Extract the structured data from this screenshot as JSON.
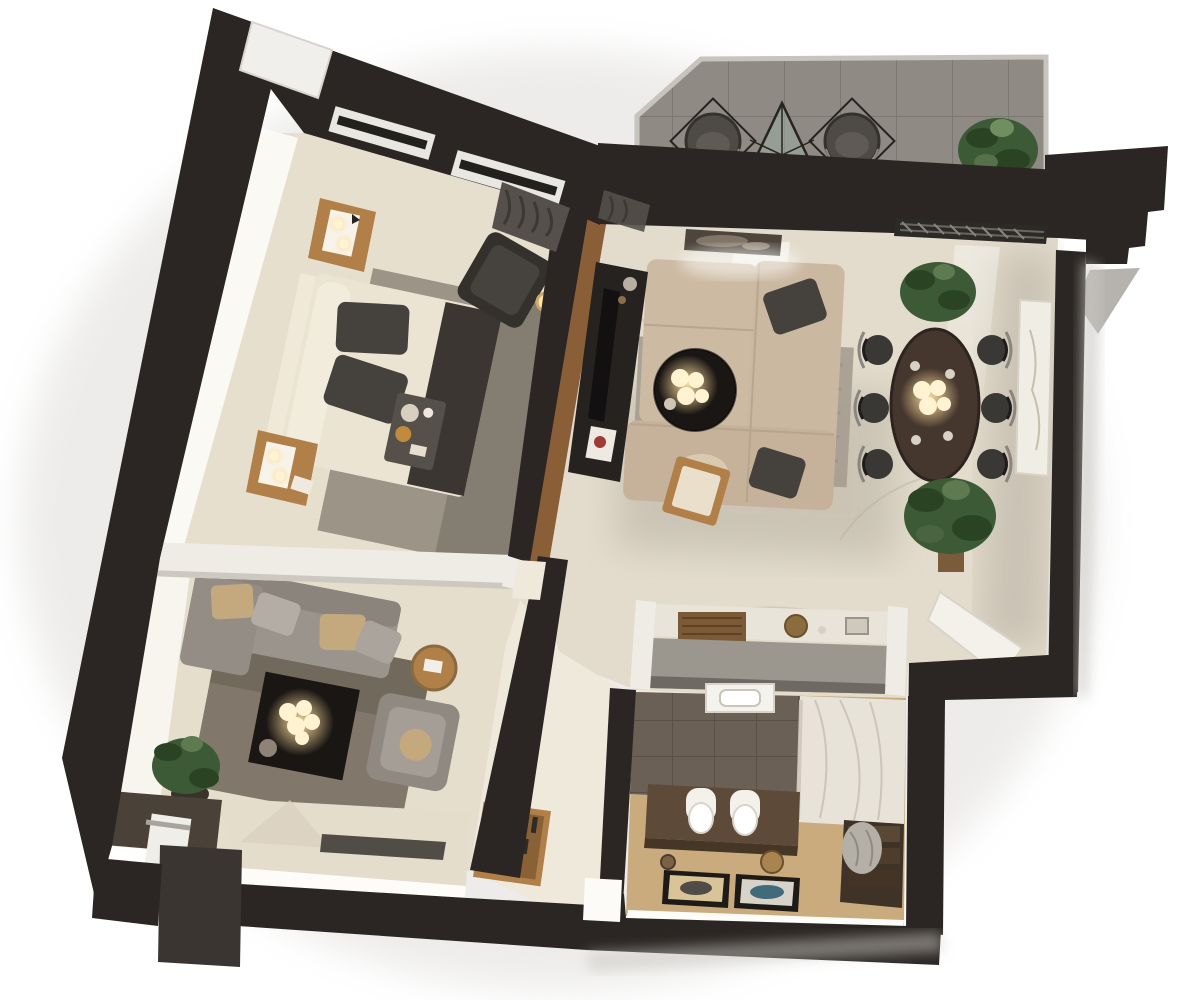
{
  "scene": {
    "kind": "3d-floor-plan-render",
    "background": "#ffffff"
  },
  "colors": {
    "wall": "#2b2623",
    "wall_light": "#3a3531",
    "terrace_tile": "#8f8b84",
    "terrace_grout": "#7c7871",
    "parapet": "#c7c4be",
    "floor_bedroom": "#e7dfce",
    "floor_living": "#e3dccc",
    "floor_lounge": "#e6decd",
    "floor_hall": "#efe9dc",
    "floor_bath_wood": "#c9ab7e",
    "tile_bath": "#6b6056",
    "tile_bath_grout": "#5a5046",
    "marble_shower": "#e8e3d9",
    "marble_vein": "#b9b1a2",
    "partition_white": "#efece5",
    "platform": "#e5ddcb",
    "glow_strip": "#fdfcf8",
    "bed": "#ece4d2",
    "bed_headboard": "#f0e9d9",
    "pillow_dark": "#45413c",
    "throw_dark": "#3b3631",
    "rug_bedroom": "#978f83",
    "rug_living": "#a89f92",
    "rug_lounge": "#7b7164",
    "sofa_beige": "#cdbaa3",
    "sofa_gray": "#9a948c",
    "pillow_tan": "#c4a87e",
    "armchair_dark": "#34302b",
    "armchair_gray": "#8f8982",
    "wood": "#b08048",
    "wood_dark": "#7d5a36",
    "wood_tv_wall": "#8a5f38",
    "console_black": "#262220",
    "table_black": "#1a1614",
    "dining_table": "#46372e",
    "chair_dark": "#3a3835",
    "metal": "#8a857d",
    "lamp_glow": "#ffe3a3",
    "lamp_globe": "#fff3d2",
    "plant_green": "#3c5a36",
    "plant_dark": "#2a4423",
    "vanity_brown": "#5e4a38",
    "bench_brown": "#3f3227",
    "toilet_white": "#f4f1ea",
    "canvas_white": "#f0ede5",
    "shadow_soft": "#d8d6d2",
    "mat_dark": "#514c45",
    "towel_gray": "#b4afa7",
    "art_fish": "#b26224",
    "art_blue": "#3f6b7a",
    "tv_black": "#121010",
    "curtain_gray": "#55504b",
    "console_front_gray": "#9b968e",
    "gold": "#c9a86a"
  }
}
